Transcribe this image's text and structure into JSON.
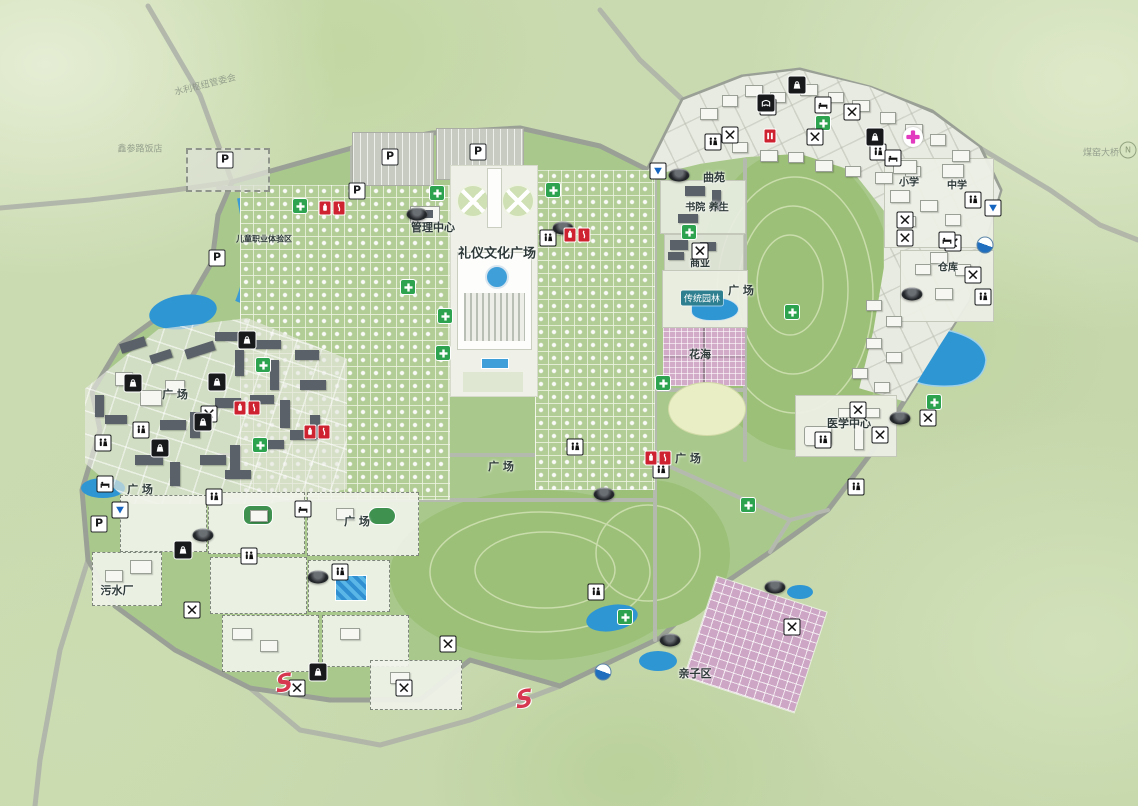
{
  "map": {
    "kind": "scenic-cemetery-master-plan",
    "labels": [
      {
        "t": "礼仪文化广场",
        "x": 497,
        "y": 252,
        "s": 13
      },
      {
        "t": "管理中心",
        "x": 433,
        "y": 227,
        "s": 11
      },
      {
        "t": "曲苑",
        "x": 714,
        "y": 177,
        "s": 11
      },
      {
        "t": "书院 养生",
        "x": 707,
        "y": 206,
        "s": 10
      },
      {
        "t": "商业",
        "x": 700,
        "y": 262,
        "s": 10
      },
      {
        "t": "传统园林",
        "x": 702,
        "y": 298,
        "s": 9,
        "chip": true
      },
      {
        "t": "花海",
        "x": 700,
        "y": 354,
        "s": 11
      },
      {
        "t": "广 场",
        "x": 741,
        "y": 290,
        "s": 11
      },
      {
        "t": "广 场",
        "x": 175,
        "y": 394,
        "s": 11
      },
      {
        "t": "广 场",
        "x": 140,
        "y": 489,
        "s": 11
      },
      {
        "t": "广 场",
        "x": 357,
        "y": 521,
        "s": 11
      },
      {
        "t": "广 场",
        "x": 501,
        "y": 466,
        "s": 11
      },
      {
        "t": "广 场",
        "x": 688,
        "y": 458,
        "s": 11
      },
      {
        "t": "医学中心",
        "x": 849,
        "y": 423,
        "s": 11
      },
      {
        "t": "污水厂",
        "x": 117,
        "y": 590,
        "s": 11
      },
      {
        "t": "亲子区",
        "x": 695,
        "y": 673,
        "s": 11
      },
      {
        "t": "小学",
        "x": 909,
        "y": 181,
        "s": 10
      },
      {
        "t": "中学",
        "x": 957,
        "y": 184,
        "s": 10
      },
      {
        "t": "仓库",
        "x": 948,
        "y": 266,
        "s": 10
      },
      {
        "t": "煤窑大桥",
        "x": 1101,
        "y": 152,
        "s": 9,
        "faint": true
      },
      {
        "t": "鑫参路饭店",
        "x": 140,
        "y": 148,
        "s": 9,
        "faint": true
      },
      {
        "t": "水利枢纽管委会",
        "x": 205,
        "y": 84,
        "s": 9,
        "faint": true,
        "rot": -14
      },
      {
        "t": "儿童职业体验区",
        "x": 264,
        "y": 239,
        "s": 8
      }
    ],
    "icons": [
      {
        "k": "parking",
        "x": 225,
        "y": 160
      },
      {
        "k": "parking",
        "x": 390,
        "y": 157
      },
      {
        "k": "parking",
        "x": 478,
        "y": 152
      },
      {
        "k": "parking",
        "x": 357,
        "y": 191
      },
      {
        "k": "parking",
        "x": 217,
        "y": 258
      },
      {
        "k": "parking",
        "x": 99,
        "y": 524
      },
      {
        "k": "medical",
        "x": 437,
        "y": 193
      },
      {
        "k": "medical",
        "x": 408,
        "y": 287
      },
      {
        "k": "medical",
        "x": 445,
        "y": 316
      },
      {
        "k": "medical",
        "x": 443,
        "y": 353
      },
      {
        "k": "medical",
        "x": 689,
        "y": 232
      },
      {
        "k": "medical",
        "x": 792,
        "y": 312
      },
      {
        "k": "medical",
        "x": 823,
        "y": 123
      },
      {
        "k": "medical",
        "x": 263,
        "y": 365
      },
      {
        "k": "medical",
        "x": 260,
        "y": 445
      },
      {
        "k": "medical",
        "x": 625,
        "y": 617
      },
      {
        "k": "medical",
        "x": 934,
        "y": 402
      },
      {
        "k": "medical",
        "x": 663,
        "y": 383
      },
      {
        "k": "medical",
        "x": 748,
        "y": 505
      },
      {
        "k": "medical",
        "x": 553,
        "y": 190
      },
      {
        "k": "medical",
        "x": 300,
        "y": 206
      },
      {
        "k": "restroom",
        "x": 548,
        "y": 238
      },
      {
        "k": "restroom",
        "x": 214,
        "y": 497
      },
      {
        "k": "restroom",
        "x": 249,
        "y": 556
      },
      {
        "k": "restroom",
        "x": 340,
        "y": 572
      },
      {
        "k": "restroom",
        "x": 141,
        "y": 430
      },
      {
        "k": "restroom",
        "x": 103,
        "y": 443
      },
      {
        "k": "restroom",
        "x": 713,
        "y": 142
      },
      {
        "k": "restroom",
        "x": 768,
        "y": 107
      },
      {
        "k": "restroom",
        "x": 878,
        "y": 152
      },
      {
        "k": "restroom",
        "x": 983,
        "y": 297
      },
      {
        "k": "restroom",
        "x": 973,
        "y": 200
      },
      {
        "k": "restroom",
        "x": 856,
        "y": 487
      },
      {
        "k": "restroom",
        "x": 823,
        "y": 440
      },
      {
        "k": "restroom",
        "x": 596,
        "y": 592
      },
      {
        "k": "restroom",
        "x": 575,
        "y": 447
      },
      {
        "k": "restroom",
        "x": 661,
        "y": 470
      },
      {
        "k": "restaurant",
        "x": 209,
        "y": 414
      },
      {
        "k": "restaurant",
        "x": 192,
        "y": 610
      },
      {
        "k": "restaurant",
        "x": 297,
        "y": 688
      },
      {
        "k": "restaurant",
        "x": 404,
        "y": 688
      },
      {
        "k": "restaurant",
        "x": 448,
        "y": 644
      },
      {
        "k": "restaurant",
        "x": 730,
        "y": 135
      },
      {
        "k": "restaurant",
        "x": 815,
        "y": 137
      },
      {
        "k": "restaurant",
        "x": 852,
        "y": 112
      },
      {
        "k": "restaurant",
        "x": 905,
        "y": 220
      },
      {
        "k": "restaurant",
        "x": 905,
        "y": 238
      },
      {
        "k": "restaurant",
        "x": 953,
        "y": 243
      },
      {
        "k": "restaurant",
        "x": 973,
        "y": 275
      },
      {
        "k": "restaurant",
        "x": 858,
        "y": 410
      },
      {
        "k": "restaurant",
        "x": 880,
        "y": 435
      },
      {
        "k": "restaurant",
        "x": 928,
        "y": 418
      },
      {
        "k": "restaurant",
        "x": 792,
        "y": 627
      },
      {
        "k": "restaurant",
        "x": 700,
        "y": 251
      },
      {
        "k": "hotel",
        "x": 105,
        "y": 484
      },
      {
        "k": "hotel",
        "x": 303,
        "y": 509
      },
      {
        "k": "hotel",
        "x": 823,
        "y": 105
      },
      {
        "k": "hotel",
        "x": 893,
        "y": 158
      },
      {
        "k": "hotel",
        "x": 947,
        "y": 240
      },
      {
        "k": "shop",
        "x": 133,
        "y": 383
      },
      {
        "k": "shop",
        "x": 247,
        "y": 340
      },
      {
        "k": "shop",
        "x": 217,
        "y": 382
      },
      {
        "k": "shop",
        "x": 203,
        "y": 422
      },
      {
        "k": "shop",
        "x": 160,
        "y": 448
      },
      {
        "k": "shop",
        "x": 797,
        "y": 85
      },
      {
        "k": "shop",
        "x": 875,
        "y": 137
      },
      {
        "k": "shop",
        "x": 183,
        "y": 550
      },
      {
        "k": "shop",
        "x": 318,
        "y": 672
      },
      {
        "k": "theater",
        "x": 766,
        "y": 103
      },
      {
        "k": "shuttle",
        "x": 417,
        "y": 214
      },
      {
        "k": "shuttle",
        "x": 563,
        "y": 228
      },
      {
        "k": "shuttle",
        "x": 679,
        "y": 175
      },
      {
        "k": "shuttle",
        "x": 912,
        "y": 294
      },
      {
        "k": "shuttle",
        "x": 604,
        "y": 494
      },
      {
        "k": "shuttle",
        "x": 670,
        "y": 640
      },
      {
        "k": "shuttle",
        "x": 203,
        "y": 535
      },
      {
        "k": "shuttle",
        "x": 318,
        "y": 577
      },
      {
        "k": "shuttle",
        "x": 900,
        "y": 418
      },
      {
        "k": "shuttle",
        "x": 775,
        "y": 587
      },
      {
        "k": "viewpoint",
        "x": 658,
        "y": 171
      },
      {
        "k": "viewpoint",
        "x": 993,
        "y": 208
      },
      {
        "k": "viewpoint",
        "x": 120,
        "y": 510
      },
      {
        "k": "gauge",
        "x": 985,
        "y": 245
      },
      {
        "k": "gauge",
        "x": 603,
        "y": 672
      },
      {
        "k": "fire",
        "x": 332,
        "y": 208
      },
      {
        "k": "fire",
        "x": 577,
        "y": 235
      },
      {
        "k": "fire",
        "x": 247,
        "y": 408
      },
      {
        "k": "fire",
        "x": 317,
        "y": 432
      },
      {
        "k": "fire",
        "x": 658,
        "y": 458
      },
      {
        "k": "badge",
        "x": 770,
        "y": 136
      },
      {
        "k": "hospital",
        "x": 913,
        "y": 137
      },
      {
        "k": "slogo",
        "x": 293,
        "y": 697
      },
      {
        "k": "slogo",
        "x": 533,
        "y": 713
      },
      {
        "k": "compass",
        "x": 1128,
        "y": 150
      }
    ],
    "colors": {
      "water": "#2f96d4",
      "park_green": "#a9c98c",
      "hill_green": "#9cc078",
      "road": "#9aa096",
      "plot_grid": "#b3cd97",
      "flower_pink": "#d2abc8",
      "kids_pink": "#cda6c5",
      "medical_green": "#2da34f",
      "hospital_magenta": "#e23bbf",
      "fire_red": "#cf2231",
      "logo_red": "#d63850"
    }
  }
}
